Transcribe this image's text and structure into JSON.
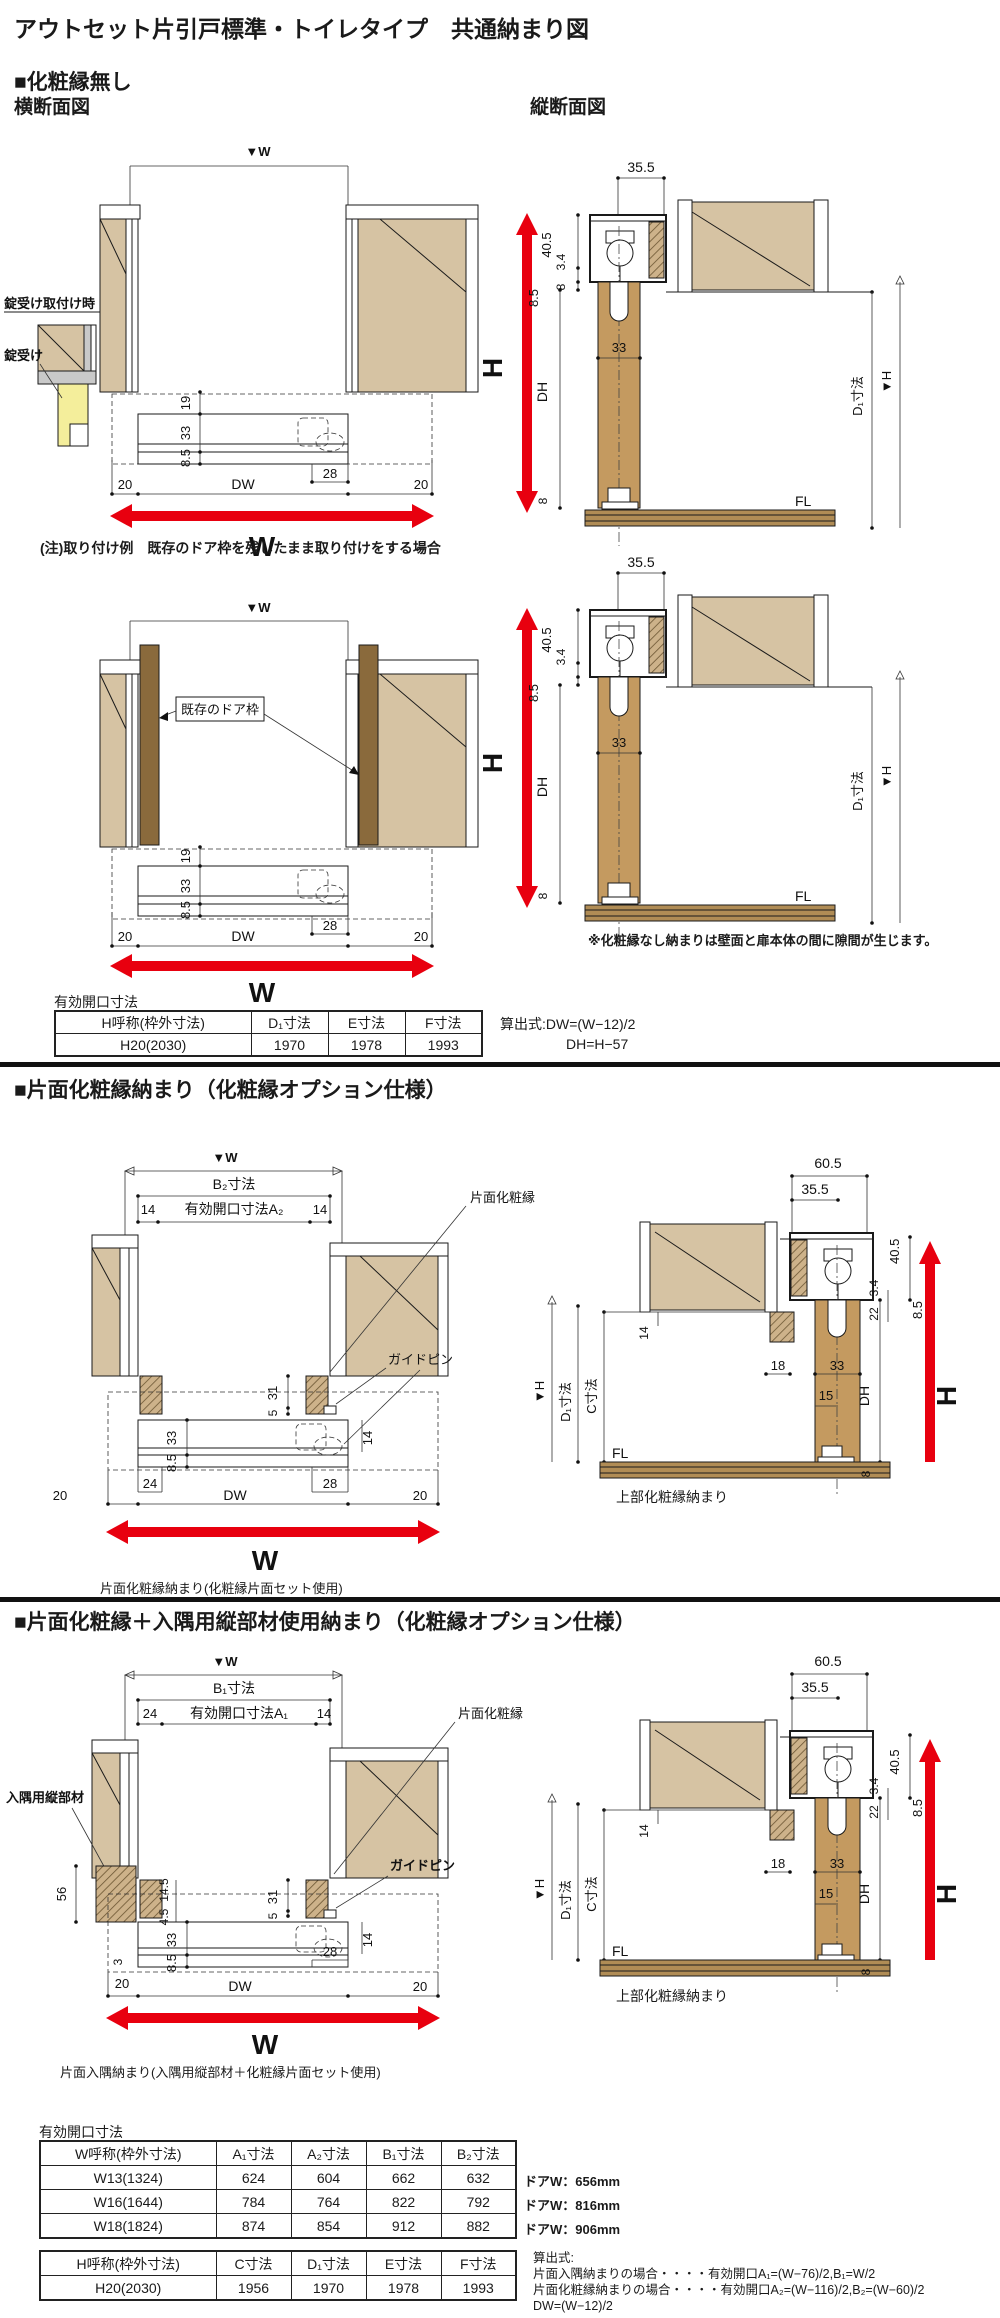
{
  "title": "アウトセット片引戸標準・トイレタイプ　共通納まり図",
  "sec1": {
    "heading": "■化粧縁無し",
    "cross_title": "横断面図",
    "vert_title": "縦断面図",
    "lock_when": "錠受け取付け時",
    "lock": "錠受け",
    "note": "(注)取り付け例　既存のドア枠を残したまま取り付けをする場合",
    "existing": "既存のドア枠",
    "gap_note": "※化粧縁なし納まりは壁面と扉本体の間に隙間が生じます。",
    "table_title": "有効開口寸法",
    "formula1": "算出式:DW=(W−12)/2",
    "formula2": "DH=H−57",
    "table": {
      "headers": [
        "H呼称(枠外寸法)",
        "D₁寸法",
        "E寸法",
        "F寸法"
      ],
      "row": [
        "H20(2030)",
        "1970",
        "1978",
        "1993"
      ]
    },
    "dims": {
      "w_top": "▼W",
      "w": "W",
      "d19": "19",
      "d33": "33",
      "d85": "8.5",
      "d20": "20",
      "dw": "DW",
      "d28": "28",
      "d355": "35.5",
      "d405": "40.5",
      "d34": "3.4",
      "d8": "8",
      "dh": "DH",
      "h": "H",
      "d1": "D₁寸法",
      "hv": "▼H",
      "fl": "FL"
    }
  },
  "sec2": {
    "heading": "■片面化粧縁納まり（化粧縁オプション仕様）",
    "cap_cross": "片面化粧縁納まり(化粧縁片面セット使用)",
    "cap_vert": "上部化粧縁納まり",
    "label_edge": "片面化粧縁",
    "label_pin": "ガイドピン",
    "dims": {
      "w_top": "▼W",
      "w": "W",
      "b2": "B₂寸法",
      "a2": "有効開口寸法A₂",
      "d14": "14",
      "d31": "31",
      "d5": "5",
      "d33": "33",
      "d85": "8.5",
      "d24": "24",
      "d20": "20",
      "dw": "DW",
      "d28": "28",
      "d605": "60.5",
      "d355": "35.5",
      "d405": "40.5",
      "d34": "3.4",
      "d22": "22",
      "d18": "18",
      "d15": "15",
      "dh": "DH",
      "h": "H",
      "hv": "▼H",
      "d1": "D₁寸法",
      "c": "C寸法",
      "fl": "FL",
      "d8": "8"
    }
  },
  "sec3": {
    "heading": "■片面化粧縁＋入隅用縦部材使用納まり（化粧縁オプション仕様）",
    "cap_cross": "片面入隅納まり(入隅用縦部材＋化粧縁片面セット使用)",
    "cap_vert": "上部化粧縁納まり",
    "label_corner": "入隅用縦部材",
    "label_edge": "片面化粧縁",
    "label_pin": "ガイドピン",
    "dims": {
      "w_top": "▼W",
      "w": "W",
      "b1": "B₁寸法",
      "a1": "有効開口寸法A₁",
      "d24": "24",
      "d14": "14",
      "d56": "56",
      "d145": "14.5",
      "d31": "31",
      "d5": "5",
      "d33": "33",
      "d45": "4.5",
      "d3": "3",
      "d20": "20",
      "d85": "8.5",
      "dw": "DW",
      "d28": "28"
    }
  },
  "bottom": {
    "table_title": "有効開口寸法",
    "tableA": {
      "headers": [
        "W呼称(枠外寸法)",
        "A₁寸法",
        "A₂寸法",
        "B₁寸法",
        "B₂寸法"
      ],
      "rows": [
        [
          "W13(1324)",
          "624",
          "604",
          "662",
          "632"
        ],
        [
          "W16(1644)",
          "784",
          "764",
          "822",
          "792"
        ],
        [
          "W18(1824)",
          "874",
          "854",
          "912",
          "882"
        ]
      ],
      "notes": [
        "ドアW：656mm",
        "ドアW：816mm",
        "ドアW：906mm"
      ]
    },
    "tableB": {
      "headers": [
        "H呼称(枠外寸法)",
        "C寸法",
        "D₁寸法",
        "E寸法",
        "F寸法"
      ],
      "row": [
        "H20(2030)",
        "1956",
        "1970",
        "1978",
        "1993"
      ]
    },
    "formulas": [
      "算出式:",
      "片面入隅納まりの場合・・・・有効開口A₁=(W−76)/2,B₁=W/2",
      "片面化粧縁納まりの場合・・・・有効開口A₂=(W−116)/2,B₂=(W−60)/2",
      "DW=(W−12)/2"
    ]
  }
}
